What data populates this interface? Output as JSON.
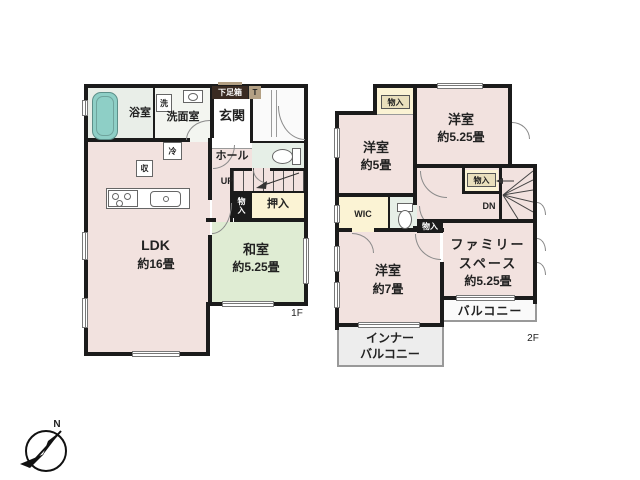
{
  "compass": {
    "north_label": "N"
  },
  "floor1": {
    "floor_label": "1F",
    "bath": {
      "label": "浴室"
    },
    "washroom": {
      "label": "洗面室",
      "washer": "洗"
    },
    "genkan": {
      "label": "玄関",
      "shoebox": "下足箱",
      "shoebox_t": "T"
    },
    "hall": {
      "label": "ホール",
      "up": "UP"
    },
    "ldk": {
      "label": "LDK",
      "size": "約16畳",
      "fridge": "冷",
      "storage": "収"
    },
    "washitsu": {
      "label": "和室",
      "size": "約5.25畳"
    },
    "oshiire": {
      "label": "押入"
    },
    "monoiri": {
      "label": "物入"
    }
  },
  "floor2": {
    "floor_label": "2F",
    "monoiri_top": {
      "label": "物入"
    },
    "yoshitsu_525": {
      "label": "洋室",
      "size": "約5.25畳"
    },
    "yoshitsu_5": {
      "label": "洋室",
      "size": "約5畳"
    },
    "wic": {
      "label": "WIC"
    },
    "monoiri_stairs": {
      "label": "物入"
    },
    "stairs": {
      "down": "DN"
    },
    "monoiri_hall": {
      "label": "物入"
    },
    "family_space": {
      "line1": "ファミリー",
      "line2": "スペース",
      "size": "約5.25畳"
    },
    "yoshitsu_7": {
      "label": "洋室",
      "size": "約7畳"
    },
    "balcony": {
      "label": "バルコニー"
    },
    "inner_balcony": {
      "line1": "インナー",
      "line2": "バルコニー"
    }
  },
  "colors": {
    "room_pink": "#f2e2df",
    "tatami_green": "#dfecd3",
    "closet_cream": "#fbf3d4",
    "bathtub_teal": "#8ecfc6",
    "sanitary_green": "#e6efe7",
    "wall_black": "#1b1b1b",
    "shoebox_brown": "#3a2b22",
    "shoebox_tan": "#b3a084"
  }
}
